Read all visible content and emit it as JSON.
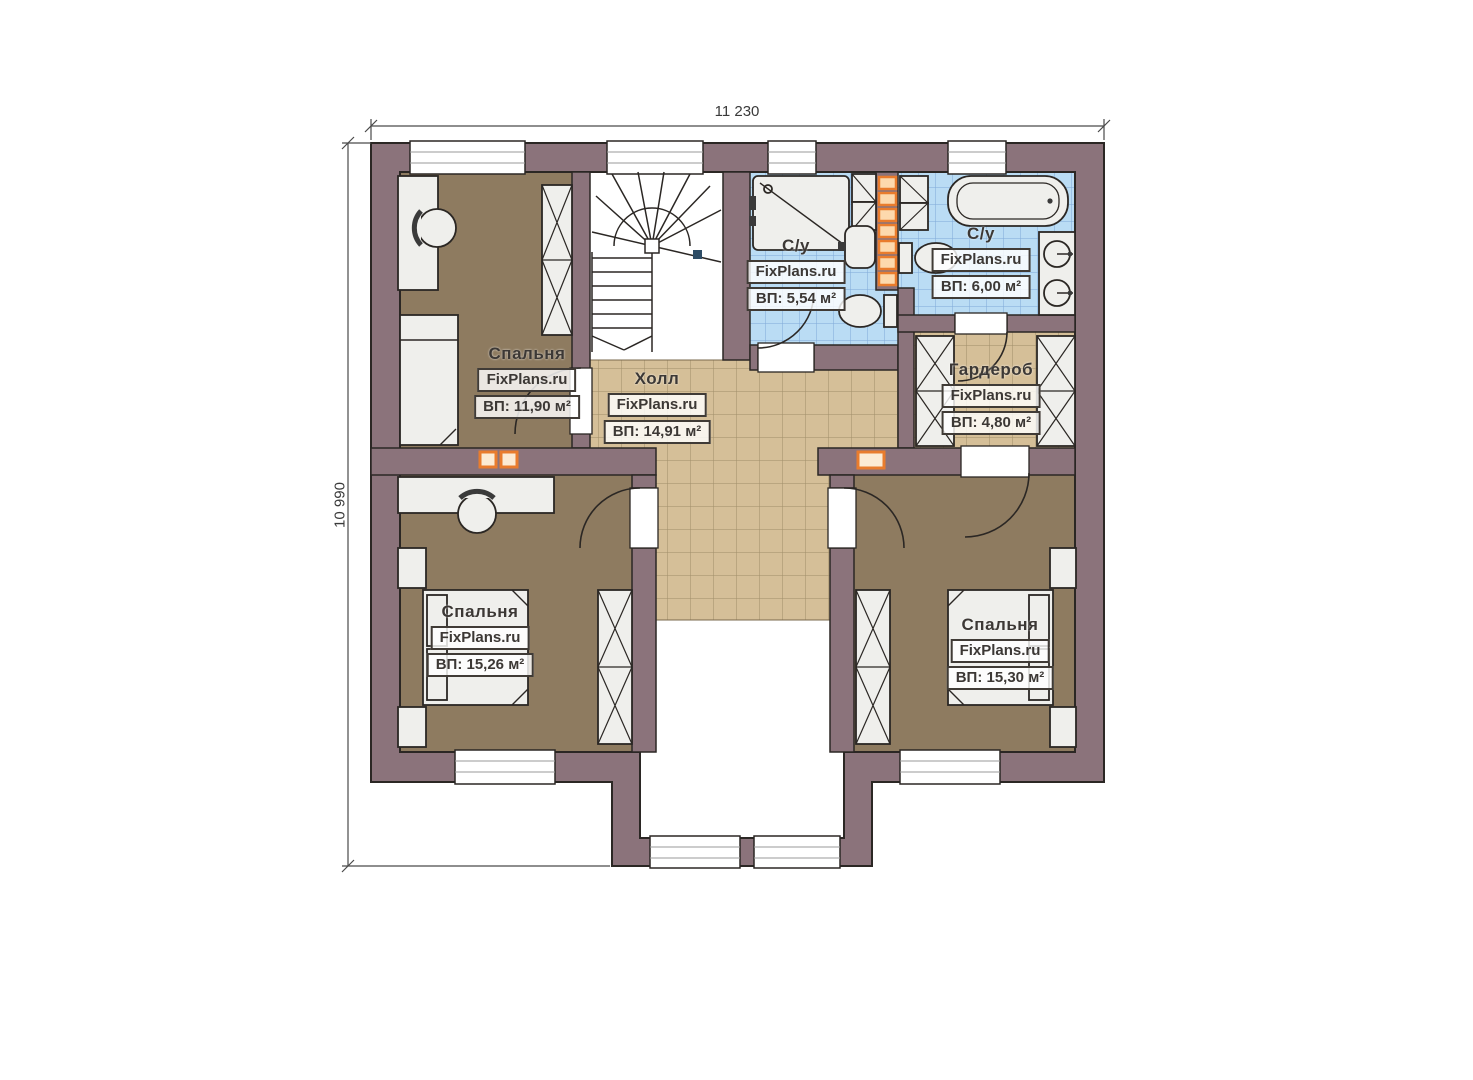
{
  "plan": {
    "dimensions": {
      "top": "11 230",
      "left": "10 990"
    },
    "rooms": [
      {
        "key": "bedroom_top_left",
        "name": "Спальня",
        "watermark": "FixPlans.ru",
        "area": "ВП: 11,90 м²"
      },
      {
        "key": "hall",
        "name": "Холл",
        "watermark": "FixPlans.ru",
        "area": "ВП: 14,91 м²"
      },
      {
        "key": "bath_shower",
        "name": "С/у",
        "watermark": "FixPlans.ru",
        "area": "ВП: 5,54 м²"
      },
      {
        "key": "bath_tub",
        "name": "С/у",
        "watermark": "FixPlans.ru",
        "area": "ВП: 6,00 м²"
      },
      {
        "key": "wardrobe",
        "name": "Гардероб",
        "watermark": "FixPlans.ru",
        "area": "ВП: 4,80 м²"
      },
      {
        "key": "bedroom_bottom_left",
        "name": "Спальня",
        "watermark": "FixPlans.ru",
        "area": "ВП: 15,26 м²"
      },
      {
        "key": "bedroom_bottom_right",
        "name": "Спальня",
        "watermark": "FixPlans.ru",
        "area": "ВП: 15,30 м²"
      }
    ],
    "colors": {
      "wall": "#8b737b",
      "bedroom_floor": "#8e7b60",
      "tile_beige": "#d5bf98",
      "tile_blue": "#badcf4",
      "accent_orange": "#e97c2d",
      "outline": "#2b2724"
    }
  }
}
